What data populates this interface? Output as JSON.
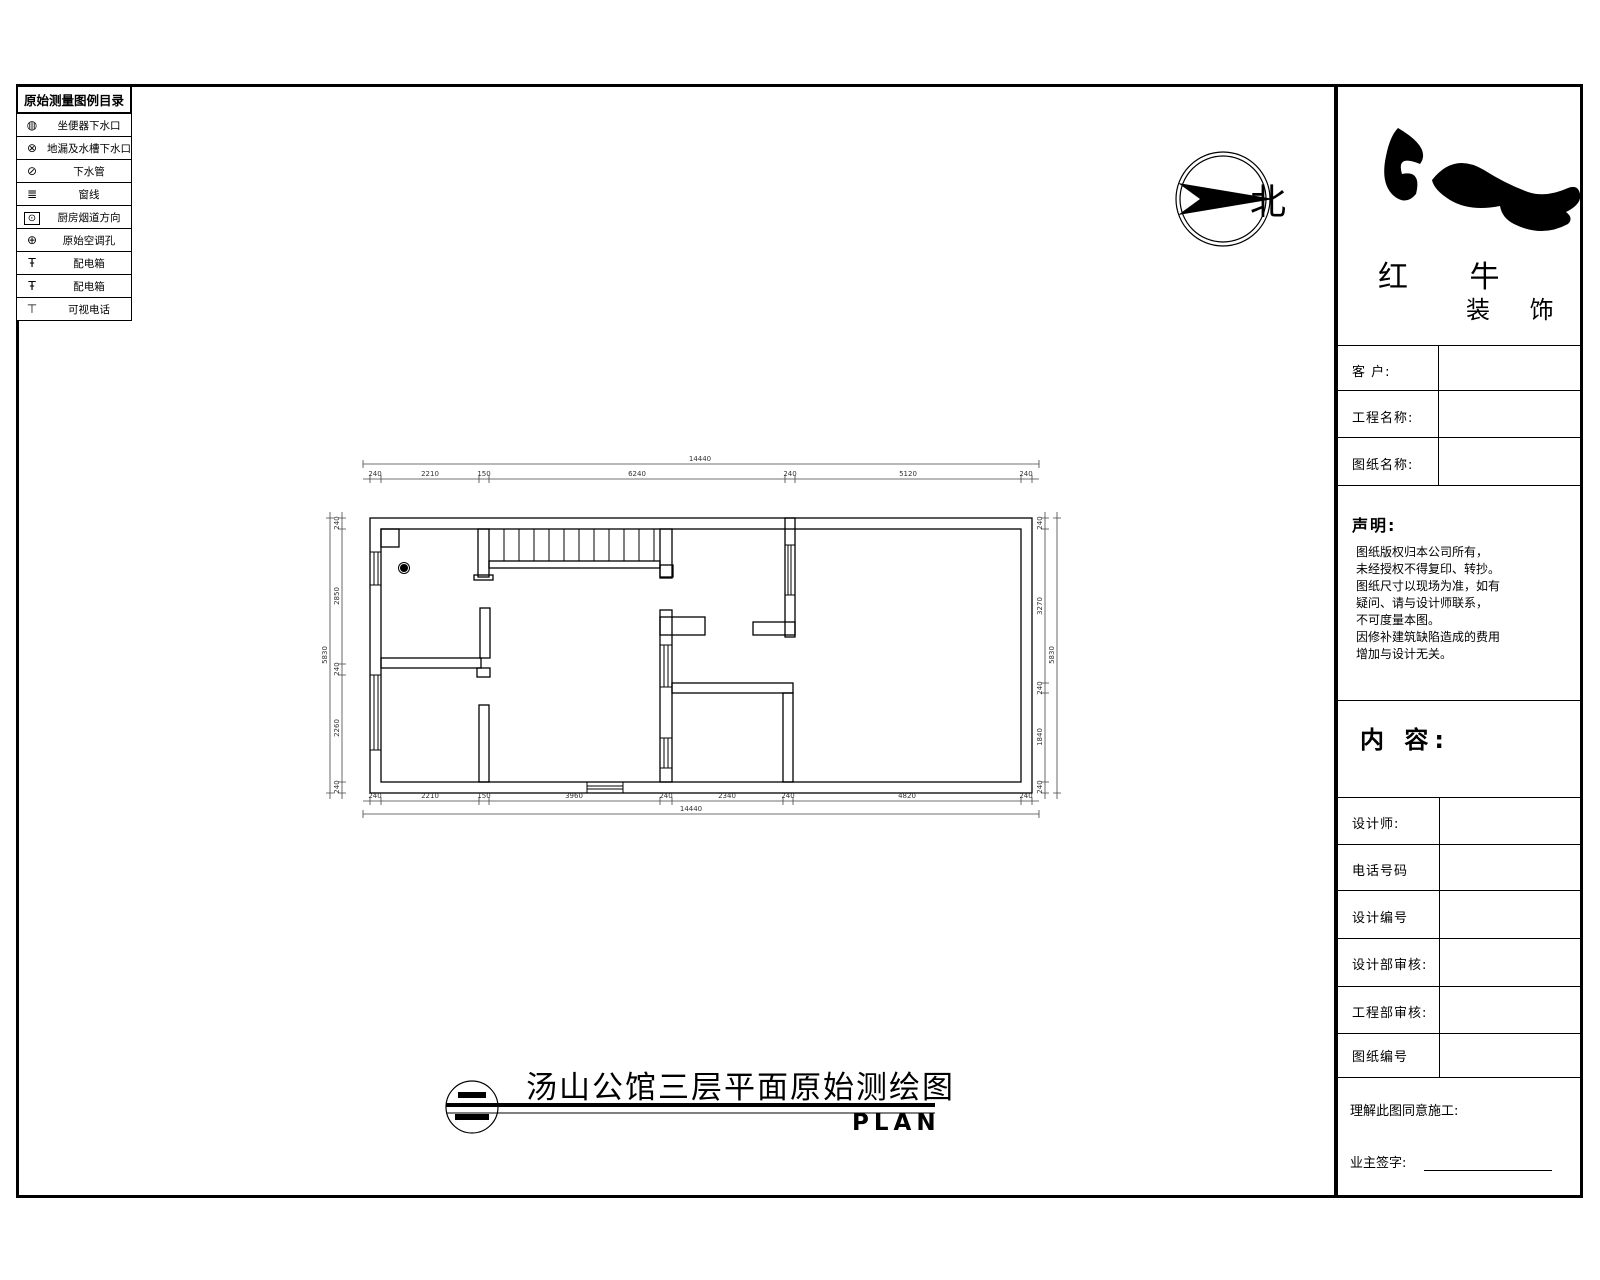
{
  "legend": {
    "title": "原始测量图例目录",
    "items": [
      {
        "icon": "toilet-drain-icon",
        "glyph": "◍",
        "label": "坐便器下水口"
      },
      {
        "icon": "floor-drain-icon",
        "glyph": "⊗",
        "label": "地漏及水槽下水口"
      },
      {
        "icon": "drain-pipe-icon",
        "glyph": "⊘",
        "label": "下水管"
      },
      {
        "icon": "window-line-icon",
        "glyph": "≣",
        "label": "窗线"
      },
      {
        "icon": "kitchen-flue-icon",
        "glyph": "⊙",
        "label": "厨房烟道方向"
      },
      {
        "icon": "ac-hole-icon",
        "glyph": "⊕",
        "label": "原始空调孔"
      },
      {
        "icon": "power-box-icon",
        "glyph": "Ŧ",
        "label": "配电箱"
      },
      {
        "icon": "distribution-box-icon",
        "glyph": "Ŧ",
        "label": "配电箱"
      },
      {
        "icon": "videophone-icon",
        "glyph": "⊤",
        "label": "可视电话"
      }
    ]
  },
  "north": {
    "label": "北"
  },
  "logo": {
    "line1": "红 牛",
    "line2": "装 饰"
  },
  "titleblock": {
    "client_label": "客  户:",
    "project_label": "工程名称:",
    "drawing_label": "图纸名称:",
    "statement_title": "声明:",
    "statement_text": "图纸版权归本公司所有，\n未经授权不得复印、转抄。\n图纸尺寸以现场为准，如有\n疑问、请与设计师联系，\n不可度量本图。\n因修补建筑缺陷造成的费用\n增加与设计无关。",
    "content_label": "内 容:",
    "rows": [
      {
        "label": "设计师:"
      },
      {
        "label": "电话号码"
      },
      {
        "label": "设计编号"
      },
      {
        "label": "设计部审核:"
      },
      {
        "label": "工程部审核:"
      },
      {
        "label": "图纸编号"
      }
    ],
    "approval_label": "理解此图同意施工:",
    "signature_label": "业主签字:"
  },
  "plan": {
    "title": "汤山公馆三层平面原始测绘图",
    "plan_label": "PLAN",
    "sheet_symbol": "二",
    "dims": {
      "top_overall": "14440",
      "top": [
        "240",
        "2210",
        "150",
        "6240",
        "240",
        "5120",
        "240"
      ],
      "bottom": [
        "240",
        "2210",
        "150",
        "3960",
        "240",
        "2340",
        "240",
        "4820",
        "240"
      ],
      "bottom_overall": "14440",
      "left": [
        "240",
        "2850",
        "240",
        "2260",
        "240"
      ],
      "left_overall": "5830",
      "right": [
        "240",
        "3270",
        "240",
        "1840",
        "240"
      ],
      "right_overall": "5830"
    }
  }
}
